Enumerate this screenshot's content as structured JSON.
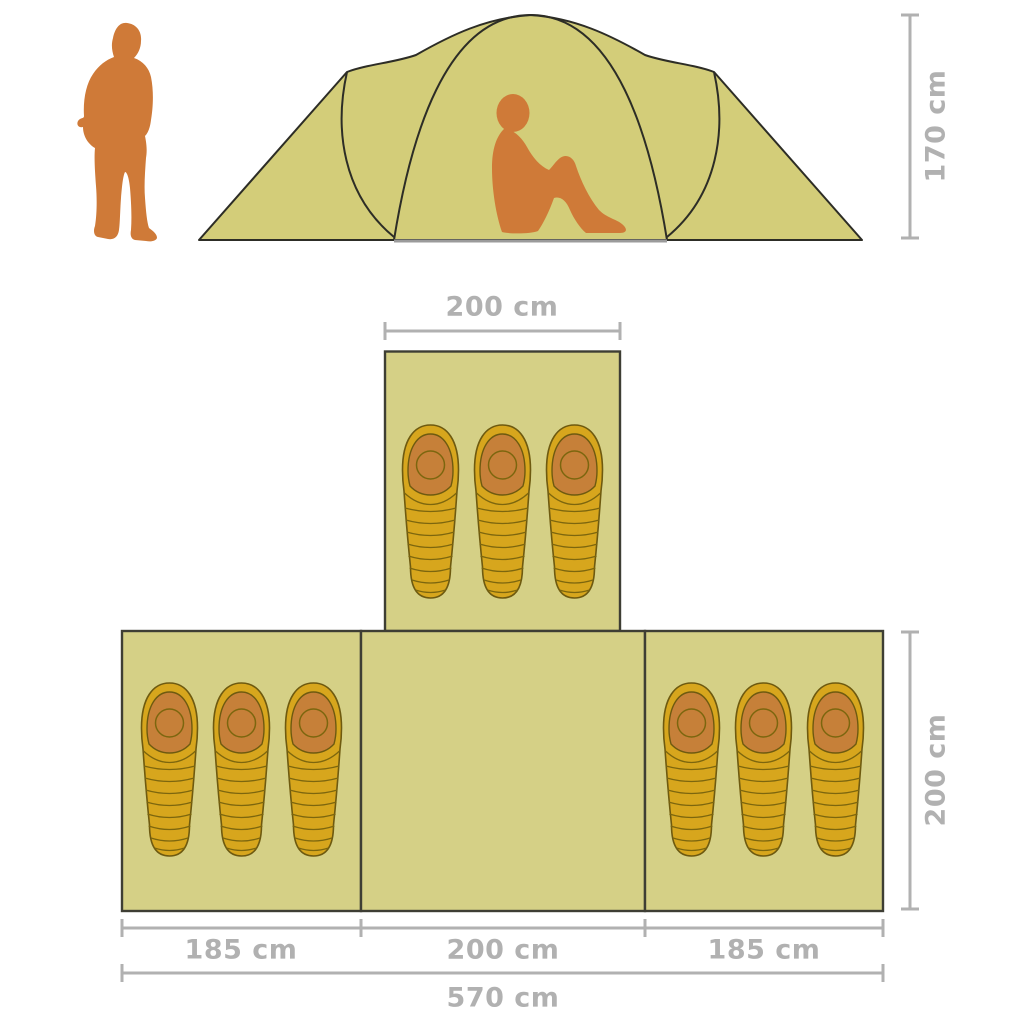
{
  "page": {
    "width": 1024,
    "height": 1024,
    "background": "#ffffff"
  },
  "colors": {
    "background": "#ffffff",
    "tent_fabric": "#d3cd79",
    "tent_outline": "#2d2d26",
    "room_fill": "#d5d086",
    "room_outline": "#3e3e34",
    "bag_fill": "#d7a61d",
    "bag_outline": "#6e5a10",
    "bag_quilt": "#7c660e",
    "bag_hood": "#c68039",
    "person": "#cf7a38",
    "dimension": "#b1b1b1",
    "ground_line": "#9b9b9b"
  },
  "labels": {
    "tent_height": "170 cm",
    "top_room_width": "200 cm",
    "room_depth": "200 cm",
    "left_room_width": "185 cm",
    "center_room_width": "200 cm",
    "right_room_width": "185 cm",
    "total_width": "570 cm"
  },
  "dimensions": {
    "unit": "cm",
    "tent_height_cm": 170,
    "top_room_width_cm": 200,
    "room_depth_cm": 200,
    "left_room_width_cm": 185,
    "center_room_width_cm": 200,
    "right_room_width_cm": 185,
    "total_width_cm": 570
  },
  "floor_plan": {
    "rooms": [
      {
        "id": "top-room",
        "sleeping_bags": 3
      },
      {
        "id": "left-room",
        "sleeping_bags": 3
      },
      {
        "id": "center-room",
        "sleeping_bags": 0
      },
      {
        "id": "right-room",
        "sleeping_bags": 3
      }
    ],
    "total_sleeping_bags": 9
  },
  "icons": {
    "person_standing": "orange hiker silhouette used as height reference",
    "person_sitting": "orange seated person silhouette inside tent",
    "tent_front_view": "khaki dome tent front elevation",
    "sleeping_bag": "mummy sleeping bag seen from above"
  }
}
